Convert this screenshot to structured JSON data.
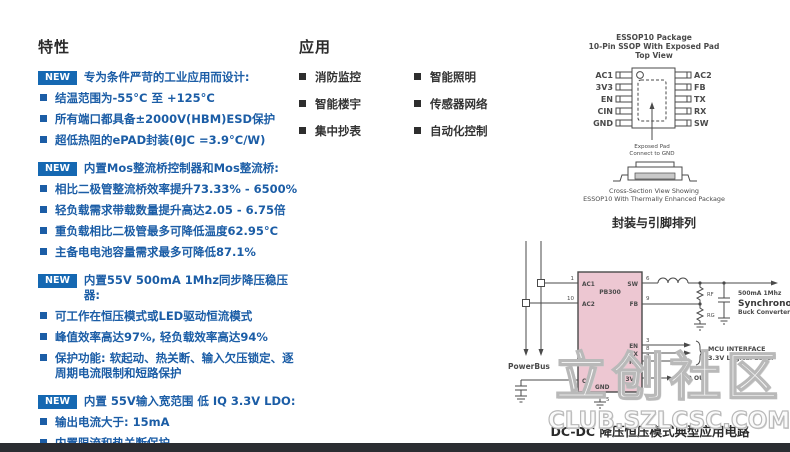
{
  "colors": {
    "accent_blue": "#1b5da6",
    "badge_blue": "#1568b2",
    "chip_pink": "#edc7d2",
    "line_gray": "#4a4a4a",
    "footer": "#2b2d32"
  },
  "features": {
    "title": "特性",
    "new_label": "NEW",
    "groups": [
      {
        "header": "专为条件严苛的工业应用而设计:",
        "items": [
          "结温范围为-55°C 至 +125°C",
          "所有端口都具备±2000V(HBM)ESD保护",
          "超低热阻的ePAD封装(θJC =3.9°C/W)"
        ]
      },
      {
        "header": "内置Mos整流桥控制器和Mos整流桥:",
        "items": [
          "相比二极管整流桥效率提升73.33% - 6500%",
          "轻负载需求带载数量提升高达2.05 - 6.75倍",
          "重负载相比二极管最多可降低温度62.95°C",
          "主备电电池容量需求最多可降低87.1%"
        ]
      },
      {
        "header": "内置55V 500mA 1Mhz同步降压稳压器:",
        "items": [
          "可工作在恒压模式或LED驱动恒流模式",
          "峰值效率高达97%, 轻负载效率高达94%",
          "保护功能: 软起动、热关断、输入欠压锁定、逐周期电流限制和短路保护"
        ]
      },
      {
        "header": "内置 55V输入宽范围 低 IQ 3.3V LDO:",
        "items": [
          "输出电流大于: 15mA",
          "内置限流和热关断保护",
          "精度: 2%; 全温度范围3%"
        ]
      }
    ]
  },
  "applications": {
    "title": "应用",
    "column1": [
      "消防监控",
      "智能楼宇",
      "集中抄表"
    ],
    "column2": [
      "智能照明",
      "传感器网络",
      "自动化控制"
    ]
  },
  "package": {
    "title1": "ESSOP10 Package",
    "title2": "10-Pin SSOP With Exposed Pad",
    "title3": "Top View",
    "left_pins": [
      "AC1",
      "3V3",
      "EN",
      "CIN",
      "GND"
    ],
    "right_pins": [
      "AC2",
      "FB",
      "TX",
      "RX",
      "SW"
    ],
    "pad_note1": "Exposed Pad",
    "pad_note2": "Connect to GND",
    "xsec1": "Cross-Section View Showing",
    "xsec2": "ESSOP10 With Thermally Enhanced Package",
    "pin_caption": "封装与引脚排列"
  },
  "schematic": {
    "chip_label": "PB300",
    "powerbus_label": "PowerBus",
    "pin_labels": {
      "ac1": "AC1",
      "ac2": "AC2",
      "cin": "CIN",
      "sw": "SW",
      "fb": "FB",
      "en": "EN",
      "tx": "TX",
      "rx": "RX",
      "v33": "3V3",
      "gnd": "GND"
    },
    "pin_numbers": {
      "ac1": "1",
      "ac2": "10",
      "cin": "4",
      "sw": "6",
      "fb": "9",
      "en": "3",
      "tx": "8",
      "rx": "7",
      "v33": "2",
      "gnd": "5"
    },
    "rf_label": "RF",
    "rg_label": "RG",
    "buck1": "500mA 1Mhz",
    "buck2": "Synchronous",
    "buck3": "Buck Converter",
    "mcu1": "MCU INTERFACE",
    "mcu2": "3.3V Logical Level",
    "ldo_label": "LDO OUT",
    "caption": "DC-DC 降压恒压模式典型应用电路"
  },
  "watermark": {
    "cn": "立创社区",
    "en": "CLUB.SZLCSC.COM"
  }
}
